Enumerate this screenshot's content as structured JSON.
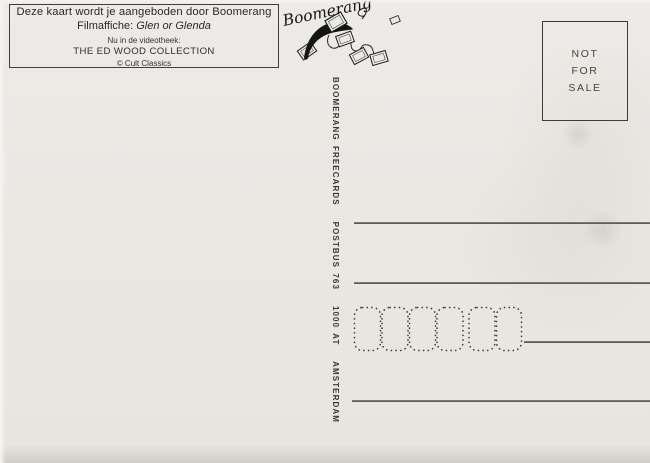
{
  "card": {
    "info_box": {
      "line1": "Deze kaart wordt je aangeboden door Boomerang",
      "line2_prefix": "Filmaffiche: ",
      "line2_title": "Glen or Glenda",
      "line3": "Nu in de videotheek:",
      "line4": "THE ED WOOD COLLECTION",
      "line5": "© Cult Classics"
    },
    "logo": {
      "brand": "Boomerang",
      "icon": "boomerang-with-flying-cards"
    },
    "spine_text": "BOOMERANG FREECARDS   POSTBUS 763   1000 AT   AMSTERDAM",
    "stamp_box": {
      "lines": [
        "NOT",
        "FOR",
        "SALE"
      ]
    },
    "address": {
      "rule_count": 4,
      "postcode_cells": 6,
      "postcode_groups": [
        4,
        2
      ]
    },
    "colors": {
      "paper": "#e9e7e2",
      "ink": "#2b2a28",
      "rule": "#5a5854",
      "border": "#3f3e3c"
    }
  }
}
